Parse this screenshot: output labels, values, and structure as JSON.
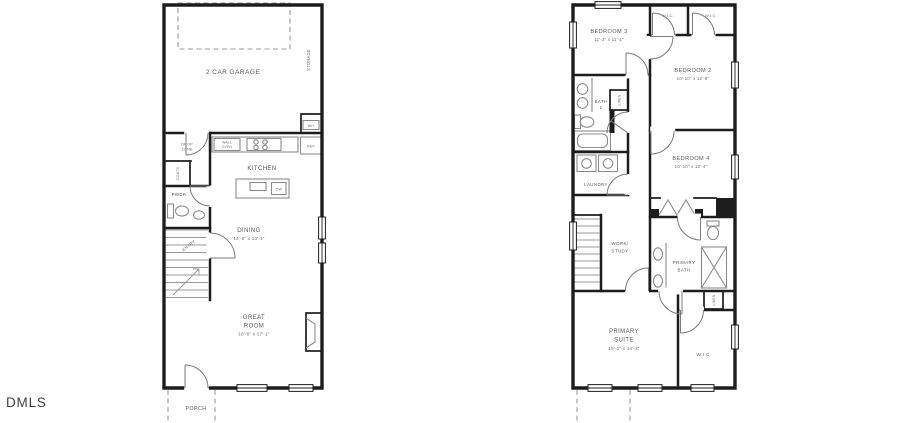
{
  "colors": {
    "wall": "#1d1d1d",
    "fixture": "#8c8c8c",
    "text": "#565656",
    "dashed": "#9b9b9b",
    "background": "#ffffff",
    "watermark": "#3f3f3f"
  },
  "watermark": "DMLS",
  "floor1": {
    "garage_label": "2 CAR GARAGE",
    "storage_label": "STORAGE",
    "wh_label": "WH",
    "wall_oven_line1": "WALL",
    "wall_oven_line2": "OVEN",
    "ref_label": "REF",
    "kitchen_label": "KITCHEN",
    "dw_label": "DW",
    "drop_zone_line1": "DROP",
    "drop_zone_line2": "ZONE",
    "coats_label": "COATS",
    "pwdr_label": "PWDR",
    "entry_label": "ENTRY",
    "dining_label": "DINING",
    "dining_dims": "14'-5\" x 10'-1\"",
    "great_room_line1": "GREAT",
    "great_room_line2": "ROOM",
    "great_room_dims": "18'-6\" x 17'-1\"",
    "porch_label": "PORCH"
  },
  "floor2": {
    "bedroom3_label": "BEDROOM 3",
    "bedroom3_dims": "11'-3\" x 11'-1\"",
    "wic1_label": "W.I.C.",
    "wic2_label": "W.I.C.",
    "wic3_label": "W.I.C.",
    "bedroom2_label": "BEDROOM 2",
    "bedroom2_dims": "10'-10\" x 12'-8\"",
    "bedroom4_label": "BEDROOM 4",
    "bedroom4_dims": "10'-10\" x 12'-4\"",
    "bath2_line1": "BATH",
    "bath2_line2": "2",
    "linen1_label": "LINEN",
    "linen2_label": "LINEN",
    "laundry_label": "LAUNDRY",
    "work_study_line1": "WORK/",
    "work_study_line2": "STUDY",
    "primary_bath_line1": "PRIMARY",
    "primary_bath_line2": "BATH",
    "primary_suite_line1": "PRIMARY",
    "primary_suite_line2": "SUITE",
    "primary_suite_dims": "15'-1\" x 14'-3\""
  }
}
